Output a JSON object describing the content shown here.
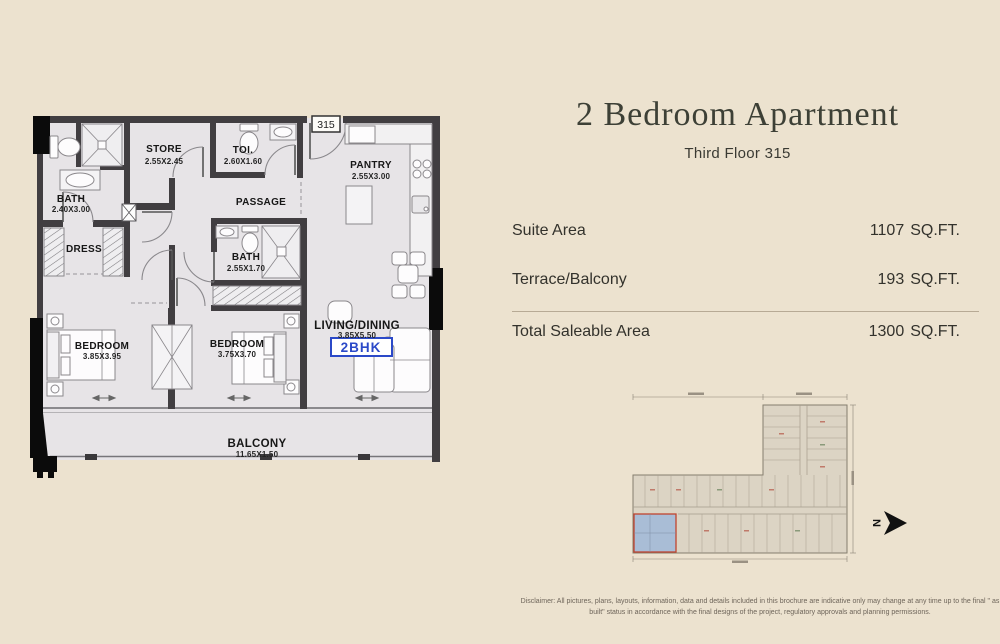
{
  "page": {
    "background": "#ece2cf"
  },
  "header": {
    "title": "2 Bedroom Apartment",
    "subtitle": "Third Floor 315"
  },
  "areas": {
    "rows": [
      {
        "label": "Suite Area",
        "value": "1107",
        "unit": "SQ.FT."
      },
      {
        "label": "Terrace/Balcony",
        "value": "193",
        "unit": "SQ.FT."
      },
      {
        "label": "Total Saleable Area",
        "value": "1300",
        "unit": "SQ.FT."
      }
    ]
  },
  "floorplan": {
    "unit_number": "315",
    "unit_type_badge": "2BHK",
    "badge_color": "#2b49c8",
    "rooms": {
      "bath1": {
        "name": "BATH",
        "dims": "2.40X3.00"
      },
      "store": {
        "name": "STORE",
        "dims": "2.55X2.45"
      },
      "toi": {
        "name": "TOI.",
        "dims": "2.60X1.60"
      },
      "pantry": {
        "name": "PANTRY",
        "dims": "2.55X3.00"
      },
      "passage": {
        "name": "PASSAGE"
      },
      "dress": {
        "name": "DRESS"
      },
      "bath2": {
        "name": "BATH",
        "dims": "2.55X1.70"
      },
      "bedroom1": {
        "name": "BEDROOM",
        "dims": "3.85X3.95"
      },
      "bedroom2": {
        "name": "BEDROOM",
        "dims": "3.75X3.70"
      },
      "living": {
        "name": "LIVING/DINING",
        "dims": "3.85X5.50"
      },
      "balcony": {
        "name": "BALCONY",
        "dims": "11.65X1.50"
      }
    }
  },
  "keyplan": {
    "north_label": "N",
    "highlight_color": "#a9bdd6",
    "highlight_border": "#c0452f"
  },
  "disclaimer": {
    "text": "Disclaimer: All pictures, plans, layouts, information, data and details included in this brochure are indicative only may change at any time up to the final \" as built\" status in accordance with the final designs of the project, regulatory approvals and planning permissions."
  }
}
